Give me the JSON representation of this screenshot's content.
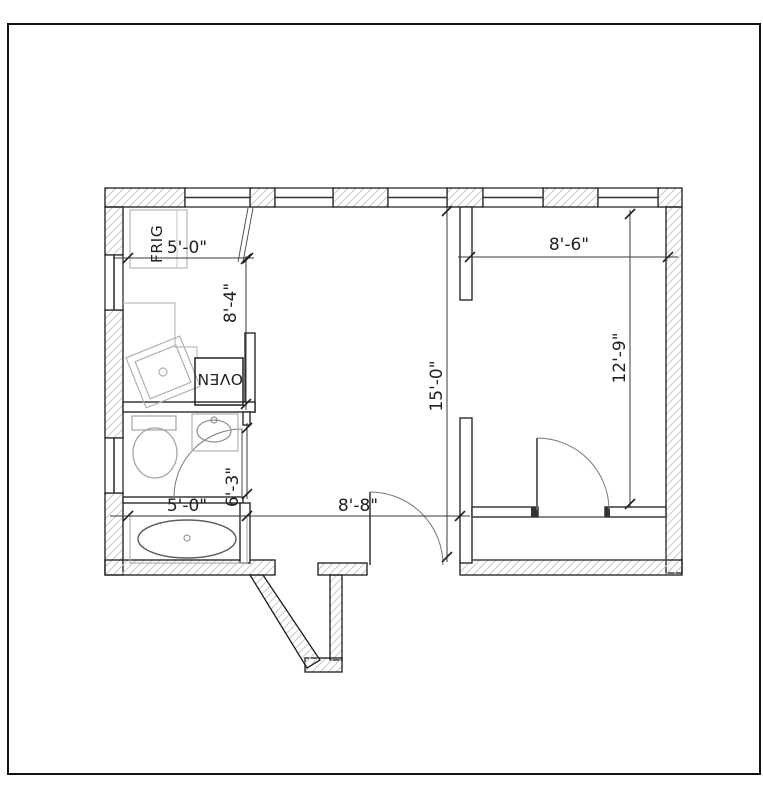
{
  "drawing": {
    "type": "apartment-floor-plan",
    "labels": {
      "fridge": "FRIG",
      "oven": "OVEN"
    },
    "dimensions": {
      "kitchen_width": "5'-0\"",
      "kitchen_depth": "8'-4\"",
      "right_room_width": "8'-6\"",
      "living_depth": "15'-0\"",
      "right_room_depth": "12'-9\"",
      "bath_door": "6'-3\"",
      "bath_width": "5'-0\"",
      "hall_width": "8'-8\""
    },
    "colors": {
      "wall_line": "#1a1a1a",
      "hatch": "#c9c9c9",
      "interior_wall": "#2a2a2a",
      "fixture": "#aaaaaa",
      "dimension": "#3a3a3a",
      "sheet_border": "#111111"
    }
  }
}
